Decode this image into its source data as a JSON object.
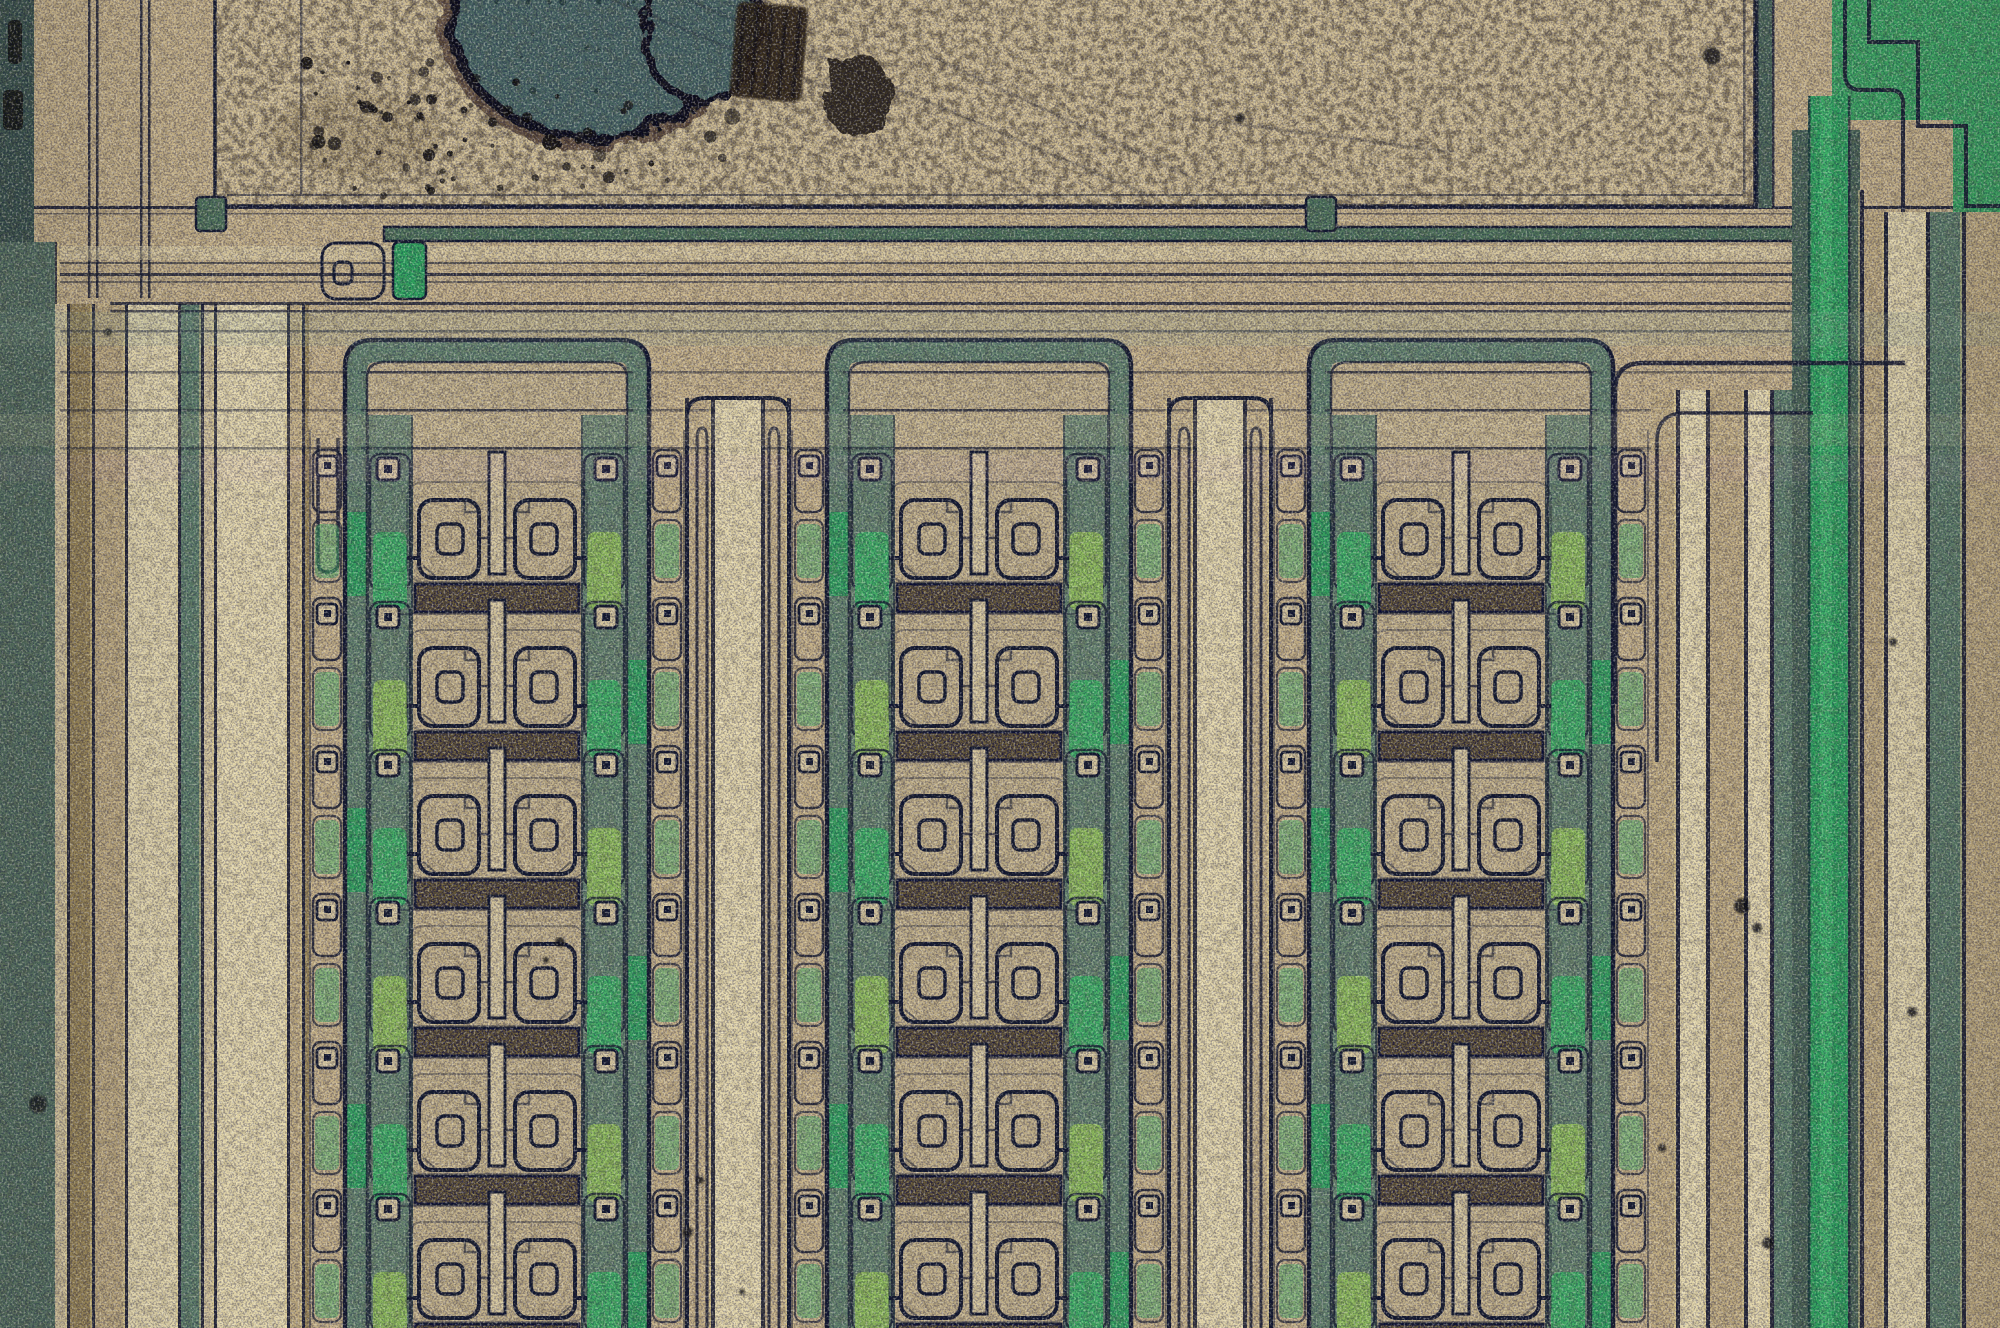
{
  "meta": {
    "type": "optical microscope die photograph",
    "subject": "Silicon integrated-circuit die under optical microscope: damaged aluminium bond pad with dark melt blob, debris and scratches, above three columns of repeating spiral-gate transistor cells, green passivation rails and vertical metal bus stripes, die edge at left",
    "width": 2000,
    "height": 1328,
    "features": [
      "bond pad with electrical-overstress melt blob",
      "debris speckle field on pad",
      "diagonal probe scratches",
      "three columns of transistor cells",
      "mirrored 9-and-e shaped gate metallization per cell",
      "speckled emitter resistor bar per cell",
      "green contact rails with square vias",
      "inverted-U metal bus combs between columns",
      "bright green vertical supply rail at right",
      "stair-step traces in top-right corner",
      "dark die street / edge at left"
    ],
    "cell_rows_visible": 6,
    "cell_columns": 3
  },
  "palette": {
    "base": "#c5b186",
    "tan_mid": "#bfab7e",
    "tan_light": "#d3c49a",
    "tan_bright": "#e4d7aa",
    "olive": "#9a8757",
    "sage": "#5e7f68",
    "sage_dark": "#4a6554",
    "sage_edge": "#55715f",
    "bright_green": "#2fa35c",
    "green_core": "#49c273",
    "yellow_green": "#8fbc5a",
    "green_patch": "#3fae63",
    "channel": "#4e7257",
    "teal_edge": "#3b544b",
    "blob": "#486660",
    "blob_dot": "#223833",
    "ol": "#141a2c",
    "bar": "#6b5d35",
    "pad": "#ccba8e",
    "accent": "#ecd98f",
    "debris": "#0e0c08",
    "streak": "#2a1f10",
    "dark_patch": "#1a140c",
    "tint_green": "#8fae92",
    "tint_pink": "#d8a8c8"
  },
  "layout": {
    "canvas": {
      "w": 2000,
      "h": 1328
    },
    "left_edge": {
      "teal": [
        0,
        0,
        34,
        242
      ],
      "sage": [
        0,
        242,
        55,
        1086
      ],
      "blotches": [
        [
          8,
          20,
          14,
          44
        ],
        [
          3,
          90,
          20,
          40
        ],
        [
          12,
          248,
          9,
          14
        ]
      ],
      "blob": [
        38,
        1104,
        9
      ],
      "bright_line_x": 55
    },
    "pad": {
      "x": 215,
      "y": -12,
      "w": 1540,
      "h": 218,
      "inner_v": [
        300,
        1743
      ],
      "inner_h": 194
    },
    "pad_edge_pairs": [
      [
        88,
        96
      ],
      [
        140,
        148
      ]
    ],
    "pad_edge_pair_y1": 298,
    "damage": {
      "blob": {
        "cx": 593,
        "cy": 18,
        "rx": 142,
        "ry": 120
      },
      "lobe": {
        "cx": 702,
        "cy": 28,
        "rx": 58,
        "ry": 74
      },
      "inner_dots": 14,
      "debrisA": {
        "n": 46,
        "x0": 262,
        "x1": 570,
        "y0": 55,
        "y1": 196
      },
      "debrisB": {
        "n": 26,
        "x0": 430,
        "x1": 750,
        "y0": 105,
        "y1": 192
      },
      "smear": {
        "cx": 355,
        "cy": 135,
        "rx": 85,
        "ry": 42
      },
      "streak": {
        "x": 733,
        "y": 4,
        "w": 72,
        "h": 96,
        "rot": 5
      },
      "patch": {
        "cx": 858,
        "cy": 96,
        "rx": 34,
        "ry": 42
      },
      "scratches": [
        [
          688,
          0,
          1150,
          196
        ],
        [
          612,
          0,
          858,
          100
        ],
        [
          930,
          56,
          1188,
          176
        ],
        [
          1190,
          118,
          1452,
          152
        ]
      ]
    },
    "channel": {
      "y": 227,
      "h": 14,
      "x0": 384,
      "x1": 1945,
      "hooks": [
        196,
        1306
      ],
      "hook_y": 197,
      "hook_w": 30,
      "hook_h": 34,
      "terminus": [
        322,
        243,
        62,
        56
      ],
      "thole": [
        334,
        262,
        18,
        22
      ],
      "slot": [
        393,
        242,
        33,
        57
      ]
    },
    "hlines": [
      [
        206,
        3,
        0.9,
        34,
        1988
      ],
      [
        213,
        1.5,
        0.5,
        34,
        1988
      ],
      [
        262,
        2,
        0.6,
        60,
        1988
      ],
      [
        273,
        3,
        0.8,
        60,
        1988
      ],
      [
        281,
        2,
        0.5,
        60,
        1988
      ],
      [
        302,
        3,
        0.8,
        110,
        1948
      ],
      [
        310,
        2.5,
        0.7,
        110,
        1948
      ],
      [
        330,
        2.5,
        0.5,
        60,
        1948
      ],
      [
        371,
        2.5,
        0.45,
        60,
        1988
      ],
      [
        409,
        2.5,
        0.45,
        60,
        1988
      ],
      [
        447,
        2.5,
        0.45,
        60,
        1988
      ]
    ],
    "bands": [
      [
        246,
        14,
        "tan_bright",
        0.5
      ],
      [
        312,
        34,
        "tint_green",
        0.17
      ],
      [
        414,
        32,
        "tan_bright",
        0.13
      ],
      [
        455,
        26,
        "tint_pink",
        0.08
      ]
    ],
    "left_stripes_y": 304,
    "left_stripes": [
      [
        55,
        12,
        "tan_light"
      ],
      [
        67,
        3,
        "ol"
      ],
      [
        70,
        22,
        "olive"
      ],
      [
        92,
        3,
        "ol"
      ],
      [
        95,
        30,
        "tan_mid"
      ],
      [
        125,
        3,
        "ol"
      ],
      [
        128,
        50,
        "tan_bright"
      ],
      [
        178,
        3,
        "ol"
      ],
      [
        181,
        20,
        "sage"
      ],
      [
        201,
        3,
        "ol"
      ],
      [
        204,
        10,
        "tan_light"
      ],
      [
        214,
        3,
        "ol"
      ],
      [
        217,
        70,
        "tan_bright"
      ],
      [
        287,
        3,
        "ol"
      ],
      [
        290,
        12,
        "tan_mid"
      ],
      [
        302,
        3,
        "ol"
      ],
      [
        305,
        4,
        "olive"
      ]
    ],
    "left_loop": [
      318,
      338,
      438,
      572
    ],
    "right_stripes_y": 390,
    "right_stripes": [
      [
        1651,
        25,
        "tan_mid"
      ],
      [
        1676,
        4,
        "ol"
      ],
      [
        1680,
        26,
        "tan_bright"
      ],
      [
        1706,
        4,
        "ol"
      ],
      [
        1710,
        34,
        "tan_mid"
      ],
      [
        1744,
        4,
        "ol"
      ],
      [
        1748,
        22,
        "tan_bright"
      ],
      [
        1770,
        4,
        "ol"
      ],
      [
        1774,
        18,
        "sage"
      ],
      [
        1792,
        16,
        "sage_dark",
        130
      ],
      [
        1808,
        40,
        "bright_green",
        96
      ],
      [
        1848,
        12,
        "sage_dark",
        130
      ],
      [
        1860,
        4,
        "ol",
        190
      ],
      [
        1864,
        20,
        "tan_mid",
        212
      ],
      [
        1884,
        4,
        "ol",
        212
      ],
      [
        1888,
        38,
        "tan_bright",
        212
      ],
      [
        1926,
        4,
        "ol",
        212
      ],
      [
        1930,
        32,
        "sage",
        212
      ],
      [
        1962,
        4,
        "ol",
        212
      ],
      [
        1966,
        34,
        "tan_mid",
        212
      ]
    ],
    "green_core_rect": [
      1820,
      96,
      12,
      1232
    ],
    "green_strip_edges": [
      1808,
      1848
    ],
    "green_field": "M1832,0 H2000 V214 H1953 V120 H1832 Z",
    "steps": [
      "M1845,0 V74 Q1845,90 1861,90 H1890 Q1903,90 1903,103 V212",
      "M1869,0 V42 H1918 V126 H1966 V206 H2000"
    ],
    "pad_right_edge": {
      "rect": [
        1756,
        0,
        16,
        208
      ],
      "lines": [
        1756,
        1772
      ]
    },
    "corners": [
      "M1615,704 V391 Q1615,363 1643,363 H1905",
      "M1657,762 V441 Q1657,413 1685,413 H1813"
    ],
    "groups": {
      "centers": [
        497,
        979,
        1461
      ],
      "rows": 6,
      "pitch": 148,
      "gy0": 482,
      "glyph_half": 84,
      "rail_w": 46,
      "leg_w": 22,
      "chain_w": 36
    },
    "bus": {
      "y0": 398,
      "width": 106,
      "stripes": [
        [
          0,
          4,
          "ol"
        ],
        [
          26,
          4,
          "ol"
        ],
        [
          76,
          4,
          "ol"
        ],
        [
          102,
          4,
          "ol"
        ]
      ],
      "center_stripe": [
        30,
        46
      ],
      "cap": [
        2,
        102,
        398,
        18
      ],
      "loops": [
        [
          12,
          10
        ],
        [
          84,
          10
        ]
      ]
    },
    "specks": [
      [
        1712,
        56,
        9
      ],
      [
        1742,
        906,
        8
      ],
      [
        1757,
        928,
        5
      ],
      [
        1768,
        1243,
        6
      ],
      [
        1662,
        1148,
        4
      ],
      [
        1912,
        1012,
        5
      ],
      [
        1893,
        642,
        4
      ],
      [
        560,
        942,
        5
      ],
      [
        546,
        960,
        3
      ],
      [
        1240,
        118,
        5
      ],
      [
        108,
        332,
        4
      ],
      [
        700,
        1180,
        4
      ],
      [
        688,
        1232,
        5
      ],
      [
        742,
        1292,
        3
      ]
    ]
  }
}
